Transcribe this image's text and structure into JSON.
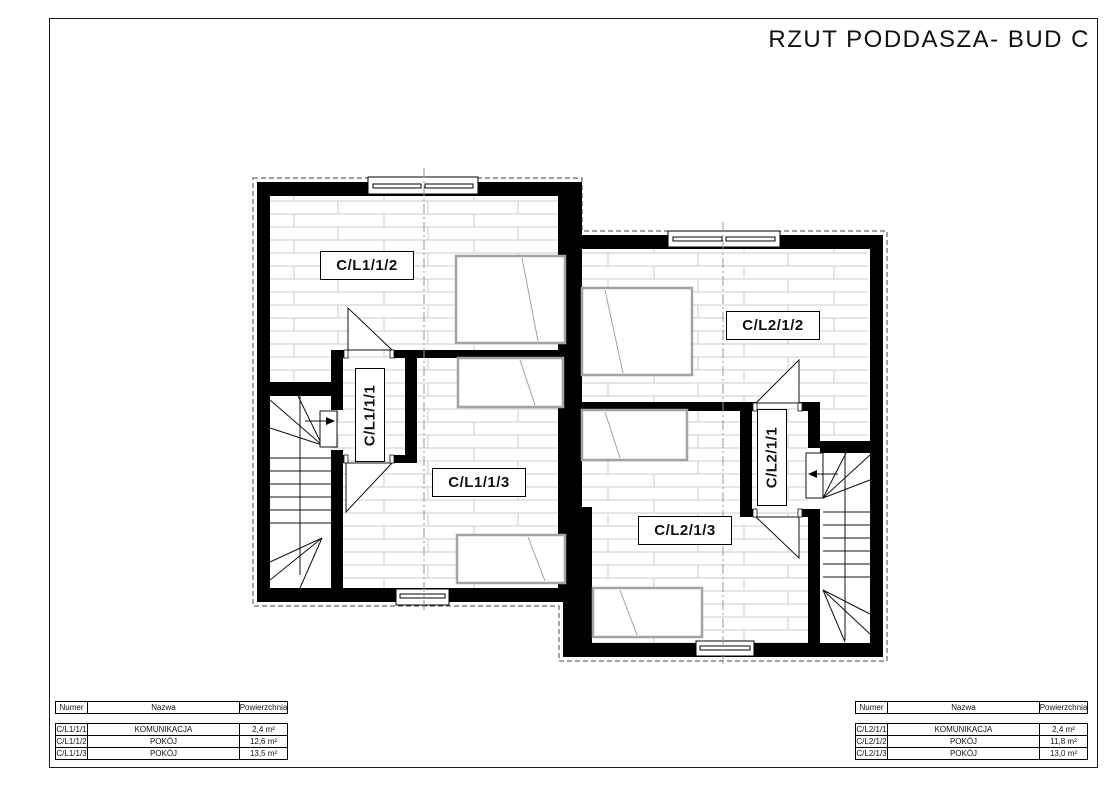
{
  "title": "RZUT PODDASZA- BUD C",
  "plan": {
    "unit_left": {
      "room_top_label": "C/L1/1/2",
      "corridor_label": "C/L1/1/1",
      "room_bottom_label": "C/L1/1/3"
    },
    "unit_right": {
      "room_top_label": "C/L2/1/2",
      "corridor_label": "C/L2/1/1",
      "room_bottom_label": "C/L2/1/3"
    }
  },
  "tables": {
    "left": {
      "headers": {
        "numer": "Numer",
        "nazwa": "Nazwa",
        "powierzchnia": "Powierzchnia"
      },
      "rows": [
        {
          "numer": "C/L1/1/1",
          "nazwa": "KOMUNIKACJA",
          "powierzchnia": "2,4 m²"
        },
        {
          "numer": "C/L1/1/2",
          "nazwa": "POKÓJ",
          "powierzchnia": "12,6 m²"
        },
        {
          "numer": "C/L1/1/3",
          "nazwa": "POKÓJ",
          "powierzchnia": "13,5 m²"
        }
      ]
    },
    "right": {
      "headers": {
        "numer": "Numer",
        "nazwa": "Nazwa",
        "powierzchnia": "Powierzchnia"
      },
      "rows": [
        {
          "numer": "C/L2/1/1",
          "nazwa": "KOMUNIKACJA",
          "powierzchnia": "2,4 m²"
        },
        {
          "numer": "C/L2/1/2",
          "nazwa": "POKÓJ",
          "powierzchnia": "11,8 m²"
        },
        {
          "numer": "C/L2/1/3",
          "nazwa": "POKÓJ",
          "powierzchnia": "13,0 m²"
        }
      ]
    }
  },
  "colors": {
    "wall": "#000000",
    "furniture": "#a3a3a3",
    "floor_lines": "#cccccc",
    "centerline": "#999999"
  }
}
